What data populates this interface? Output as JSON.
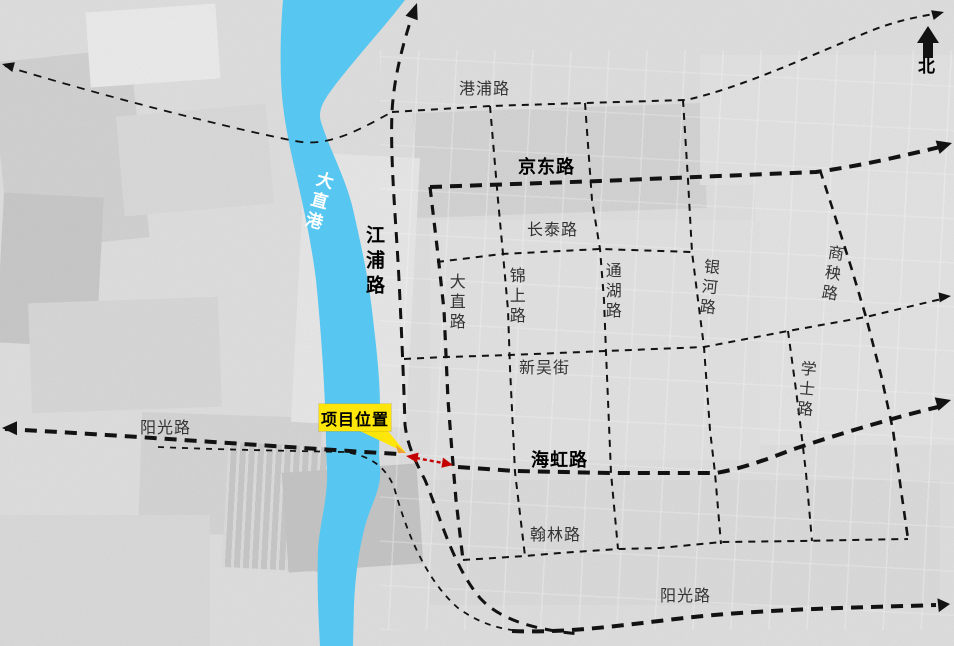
{
  "compass": {
    "label": "北"
  },
  "project_marker": {
    "label": "项目位置",
    "background_color": "#FFE60A"
  },
  "river": {
    "name": "大直港",
    "color": "#57C7F1"
  },
  "highlight_arrow": {
    "color": "#C40000",
    "style": "double-headed dashed"
  },
  "road_line_color": "#121212",
  "roads": {
    "gangpu": "港浦路",
    "jingdong": "京东路",
    "changtai": "长泰路",
    "xinwu": "新吴街",
    "dazhi": "大直路",
    "jinshang": "锦上路",
    "tonghu": "通湖路",
    "yinhe": "银河路",
    "shangyang": "商秧路",
    "xueshi": "学士路",
    "jiangpu": "江浦路",
    "haihong": "海虹路",
    "hanlin": "翰林路",
    "yangguang_west": "阳光路",
    "yangguang_south": "阳光路"
  }
}
